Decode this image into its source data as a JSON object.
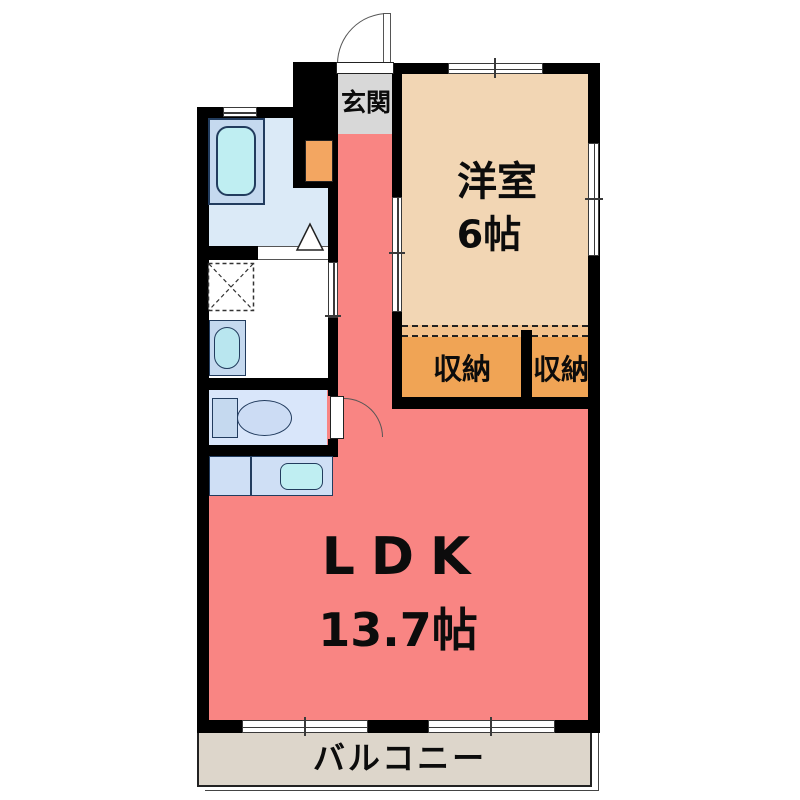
{
  "plan": {
    "labels": {
      "genkan": "玄関",
      "yoshitsu": "洋室",
      "yoshitsu_size": "6帖",
      "closet_left": "収納",
      "closet_right": "収納",
      "ldk": "LDK",
      "ldk_size": "13.7帖",
      "balcony": "バルコニー"
    },
    "colors": {
      "ldk": "#f98583",
      "yoshitsu": "#f2d6b4",
      "closet": "#f0a455",
      "closet_strip": "#f3c28c",
      "genkan": "#d8d8d8",
      "balcony": "#ddd6cb",
      "bathroom_floor": "#dbeaf7",
      "toilet_floor": "#d9e6fa",
      "fixture_blue": "#c5d9ef",
      "fixture_cyan": "#bfeef2",
      "wall": "#000000"
    }
  }
}
